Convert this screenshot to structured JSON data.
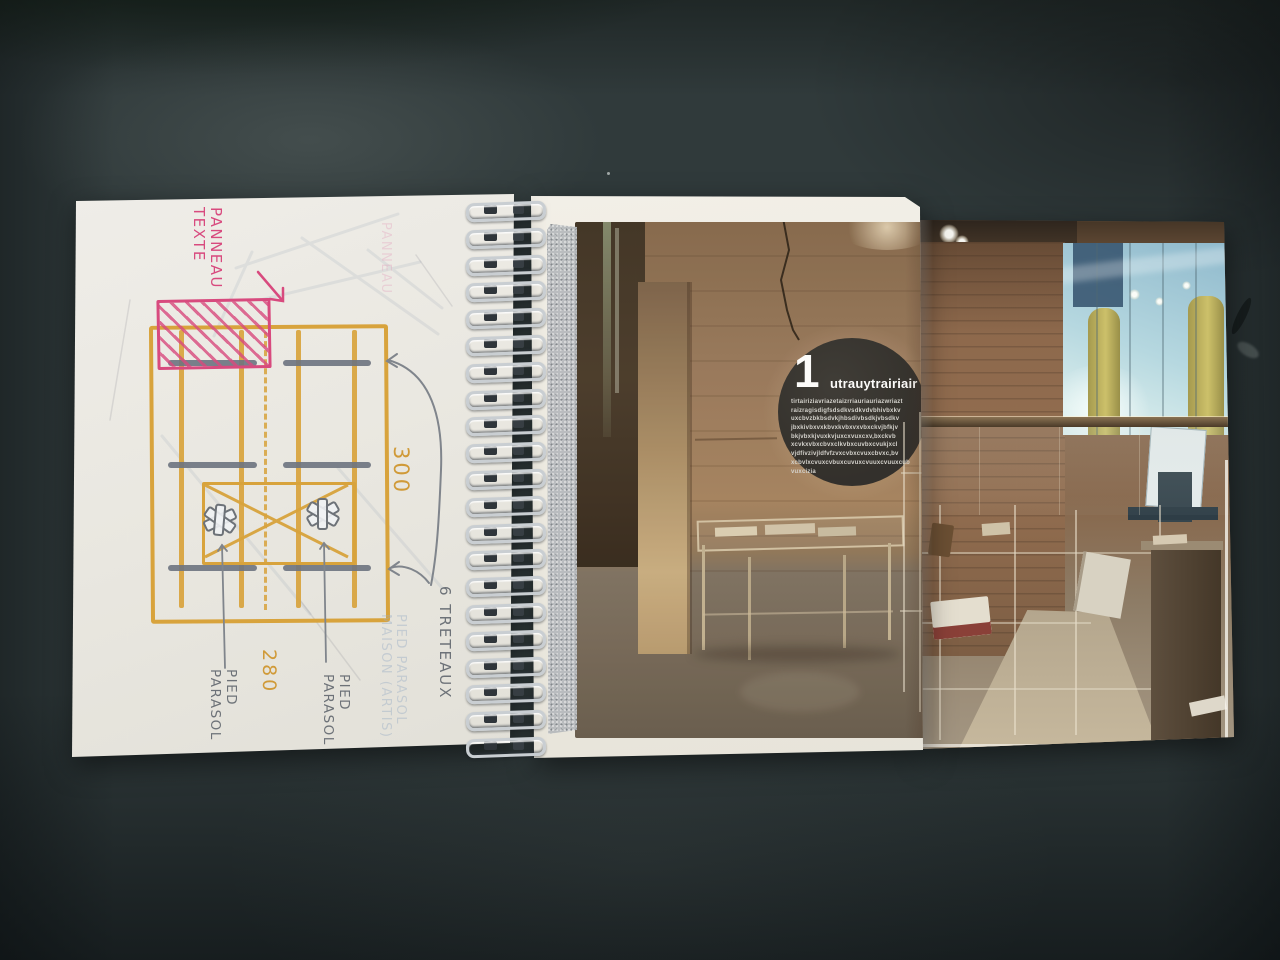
{
  "sketch": {
    "ink_colors": {
      "pink": "#d84a7e",
      "orange": "#d8a33c",
      "gray": "#6d7278"
    },
    "labels": {
      "panel": "PANNEAU\nTEXTE",
      "width": "300",
      "depth": "280",
      "trestles": "6 TRETEAUX",
      "foot_left": "PIED\nPARASOL",
      "foot_right": "PIED\nPARASOL"
    },
    "ghost_text": {
      "parasol_block": "PIED PARASOL\nMAISON (ARTIS)",
      "panneau": "PANNEAU"
    }
  },
  "print": {
    "badge": {
      "number": "1",
      "title": "utrauytrairiair",
      "background": "#2e2c29",
      "text_color": "#ffffff",
      "lines": [
        "tirtairiziavriazetaizrriauriauriazwriazt",
        "raizragisdigfsdsdkvsdkvdvbhivbxkv",
        "uxcbvzbkbsdvkjhbsdivbsdkjvbsdkv",
        "jbxkivbxvxkbvxkvbxvxvbxckvjbfkjv",
        "bkjvbxkjvuxkvjuxcxvuxcxv,bxckvb",
        "xcvkxvbxcbvxclkvbxcuvbxcvukjxcl",
        "vjdfivzivjldfvfzvxcvbxcvuxcbvxc,bv",
        "xcbvlxcvuxcvbuxcuvuxcvuuxcvuuxcub",
        "vuxcizia"
      ]
    }
  },
  "palette": {
    "desk": "#303a3b",
    "sketch_page": "#eae8e1",
    "print_page": "#eeebe2",
    "tape": "#b7babd",
    "wall_brown": "#97775a",
    "window_blue": "#b6d8e0",
    "column_yellow": "#c4b763",
    "floor": "#6f6253"
  }
}
